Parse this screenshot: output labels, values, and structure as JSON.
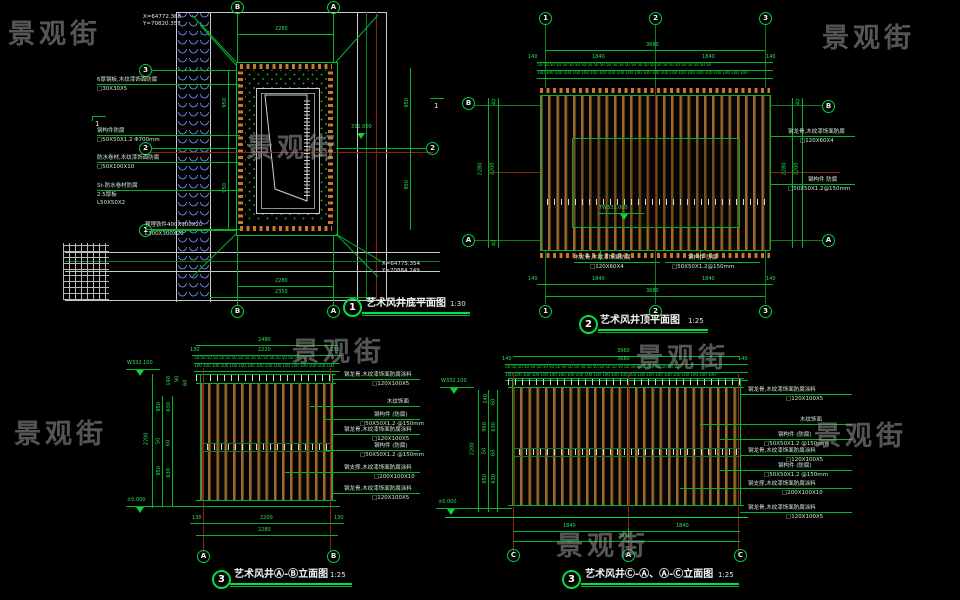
{
  "watermark": {
    "text": "景观街"
  },
  "d1": {
    "num": "1",
    "title": "艺术风井底平面图",
    "scale": "1:30",
    "coord_top_x": "X=64772.368",
    "coord_top_y": "Y=70820.357",
    "coord_bot_x": "X=64775.354",
    "coord_bot_y": "Y=70884.249",
    "elev": "331.000",
    "dim_top": "2280",
    "dim_bottom1": "2280",
    "dim_bottom2": "2350",
    "dim_r1": "950",
    "dim_r2": "950",
    "dim_l1": "950",
    "dim_l2": "950",
    "bub_top_l": "B",
    "bub_top_r": "A",
    "bub_bot_l": "B",
    "bub_bot_r": "A",
    "bub_l1": "3",
    "bub_l2": "2",
    "bub_l3": "1",
    "bub_r": "2",
    "sec": "1",
    "ann1a": "6厚钢板,木纹漆饰面防腐",
    "ann1b": "□30X30X5",
    "ann2a": "钢构件防腐",
    "ann2b": "□50X50X1.2 Φ700mm",
    "ann3a": "防水卷材,木纹漆饰面防腐",
    "ann3b": "□50X100X10",
    "ann4a": "St-防水卷材防腐",
    "ann4b": "2.5厚板",
    "ann4c": "L50X50X2",
    "ann5a": "预埋铁件400X300X20",
    "ann5b": "L300X300X20"
  },
  "d2": {
    "num": "2",
    "title": "艺术风井顶平面图",
    "scale": "1:25",
    "b1": "1",
    "b2": "2",
    "b3": "3",
    "bl_t": "B",
    "bl_b": "A",
    "total": "3680",
    "seg1": "140",
    "seg2": "1840",
    "seg3": "1840",
    "seg4": "140",
    "r50": "50 50 50 50 50 50 50 50 50 50 50 50 50 50 50 50 50 50 50 50 50 50 50 50 50 50 50 50",
    "r100": "100 100 100 100 100 100 100 100 100 100 100 100 100 100 100 100 100 100 100 100 100 100 100 100",
    "side_outer": "2280",
    "side_inner": "2200",
    "side_small": "40",
    "elev": "TW331.000",
    "annr1a": "钢龙骨,木纹漆饰面防腐",
    "annr1b": "□120X60X4",
    "annr2a": "钢构件 防腐",
    "annr2b": "□50X50X1.2@150mm",
    "annb1a": "木龙骨,木纹漆饰面防腐",
    "annb1b": "□120X60X4",
    "annb2a": "钢构件 防腐",
    "annb2b": "□50X50X1.2@150mm"
  },
  "d3": {
    "num": "3",
    "title": "艺术风井Ⓐ-Ⓑ立面图",
    "scale": "1:25",
    "total": "2480",
    "seg1": "130",
    "seg2": "2220",
    "seg3": "130",
    "r50": "50 50 50 50 50 50 50 50 50 50 50 50 50 50 50 50 50 50",
    "r100": "100 100 100 100 100 100 100 100 100 100 100 100 100 100 100 100",
    "elev_top": "W332.100",
    "elev_bot": "±0.000",
    "lt": "2200",
    "ls1": "950",
    "ls2": "50",
    "ls3": "950",
    "lq1": "630",
    "lq2": "60",
    "lq3": "630",
    "sm1": "140",
    "sm2": "90",
    "sm3": "60",
    "bseg1": "130",
    "bseg2": "2200",
    "bseg3": "130",
    "btotal": "2280",
    "ba": "A",
    "bb": "B"
  },
  "d4": {
    "num": "3",
    "title": "艺术风井Ⓒ-Ⓐ、Ⓐ-Ⓒ立面图",
    "scale": "1:25",
    "total": "3960",
    "seg1": "140",
    "seg2": "3680",
    "seg3": "140",
    "elev_top": "W332.100",
    "elev_bot": "±0.000",
    "bseg1": "1840",
    "bseg2": "1840",
    "btotal": "3680",
    "bc1": "C",
    "ba": "A",
    "bc2": "C"
  },
  "lr": {
    "total": "2200",
    "s1": [
      "140",
      "950",
      "50",
      "950"
    ],
    "s2": [
      "60",
      "630",
      "60",
      "630"
    ]
  },
  "annE": {
    "a1a": "钢龙骨,木纹漆饰面防腐涂料",
    "a1b": "□120X100X5",
    "a2": "木纹饰面",
    "a3a": "钢构件 (防腐)",
    "a3b": "□50X50X1.2 @150mm",
    "a4a": "钢龙骨,木纹漆饰面防腐涂料",
    "a4b": "□120X100X5",
    "a5a": "钢构件 (防腐)",
    "a5b": "□50X50X1.2 @150mm",
    "a6a": "钢支撑,木纹漆饰面防腐涂料",
    "a6b": "□200X100X10",
    "a7a": "钢龙骨,木纹漆饰面防腐涂料",
    "a7b": "□120X100X5"
  }
}
